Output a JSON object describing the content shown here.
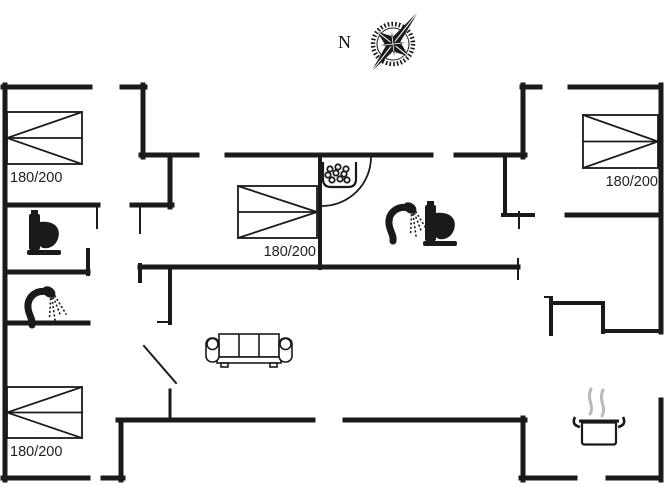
{
  "title": "Holiday house floor plan",
  "colors": {
    "line": "#1a1a1a",
    "label_text": "#1f1f1f",
    "steam": "#b9b9b9",
    "background": "#ffffff"
  },
  "plan": {
    "compass": {
      "label": "N",
      "icon": "compass-rose"
    },
    "beds": [
      {
        "label": "180/200",
        "x": 7,
        "y": 112,
        "w": 75,
        "h": 52,
        "point": "left",
        "label_x": 10,
        "label_y": 182,
        "label_anchor": "start"
      },
      {
        "label": "180/200",
        "x": 238,
        "y": 186,
        "w": 79,
        "h": 52,
        "point": "right",
        "label_x": 316,
        "label_y": 256,
        "label_anchor": "end"
      },
      {
        "label": "180/200",
        "x": 583,
        "y": 115,
        "w": 75,
        "h": 53,
        "point": "right",
        "label_x": 658,
        "label_y": 186,
        "label_anchor": "end"
      },
      {
        "label": "180/200",
        "x": 7,
        "y": 387,
        "w": 75,
        "h": 51,
        "point": "left",
        "label_x": 10,
        "label_y": 456,
        "label_anchor": "start"
      }
    ],
    "walls": [
      {
        "x1": 3,
        "y1": 87,
        "x2": 90,
        "y2": 87,
        "w": 5
      },
      {
        "x1": 122,
        "y1": 87,
        "x2": 145,
        "y2": 87,
        "w": 5
      },
      {
        "x1": 522,
        "y1": 87,
        "x2": 540,
        "y2": 87,
        "w": 5
      },
      {
        "x1": 570,
        "y1": 87,
        "x2": 661,
        "y2": 87,
        "w": 5
      },
      {
        "x1": 5,
        "y1": 85,
        "x2": 5,
        "y2": 480,
        "w": 5
      },
      {
        "x1": 661,
        "y1": 85,
        "x2": 661,
        "y2": 332,
        "w": 5
      },
      {
        "x1": 661,
        "y1": 400,
        "x2": 661,
        "y2": 480,
        "w": 5
      },
      {
        "x1": 3,
        "y1": 478,
        "x2": 88,
        "y2": 478,
        "w": 5
      },
      {
        "x1": 103,
        "y1": 478,
        "x2": 123,
        "y2": 478,
        "w": 5
      },
      {
        "x1": 121,
        "y1": 420,
        "x2": 121,
        "y2": 480,
        "w": 5
      },
      {
        "x1": 118,
        "y1": 420,
        "x2": 313,
        "y2": 420,
        "w": 5
      },
      {
        "x1": 345,
        "y1": 420,
        "x2": 525,
        "y2": 420,
        "w": 5
      },
      {
        "x1": 523,
        "y1": 418,
        "x2": 523,
        "y2": 480,
        "w": 5
      },
      {
        "x1": 521,
        "y1": 478,
        "x2": 575,
        "y2": 478,
        "w": 5
      },
      {
        "x1": 608,
        "y1": 478,
        "x2": 661,
        "y2": 478,
        "w": 5
      },
      {
        "x1": 143,
        "y1": 85,
        "x2": 143,
        "y2": 157,
        "w": 5
      },
      {
        "x1": 141,
        "y1": 155,
        "x2": 197,
        "y2": 155,
        "w": 5
      },
      {
        "x1": 227,
        "y1": 155,
        "x2": 431,
        "y2": 155,
        "w": 5
      },
      {
        "x1": 456,
        "y1": 155,
        "x2": 525,
        "y2": 155,
        "w": 5
      },
      {
        "x1": 523,
        "y1": 85,
        "x2": 523,
        "y2": 157,
        "w": 5
      },
      {
        "x1": 320,
        "y1": 155,
        "x2": 320,
        "y2": 268,
        "w": 4
      },
      {
        "x1": 505,
        "y1": 155,
        "x2": 505,
        "y2": 215,
        "w": 4
      },
      {
        "x1": 503,
        "y1": 215,
        "x2": 533,
        "y2": 215,
        "w": 4
      },
      {
        "x1": 567,
        "y1": 215,
        "x2": 661,
        "y2": 215,
        "w": 5
      },
      {
        "x1": 5,
        "y1": 205,
        "x2": 98,
        "y2": 205,
        "w": 5
      },
      {
        "x1": 97,
        "y1": 205,
        "x2": 97,
        "y2": 228,
        "w": 2
      },
      {
        "x1": 88,
        "y1": 250,
        "x2": 88,
        "y2": 274,
        "w": 4
      },
      {
        "x1": 5,
        "y1": 272,
        "x2": 88,
        "y2": 272,
        "w": 5
      },
      {
        "x1": 5,
        "y1": 323,
        "x2": 88,
        "y2": 323,
        "w": 5
      },
      {
        "x1": 170,
        "y1": 155,
        "x2": 170,
        "y2": 207,
        "w": 5
      },
      {
        "x1": 132,
        "y1": 205,
        "x2": 172,
        "y2": 205,
        "w": 5
      },
      {
        "x1": 140,
        "y1": 207,
        "x2": 140,
        "y2": 233,
        "w": 2
      },
      {
        "x1": 170,
        "y1": 267,
        "x2": 170,
        "y2": 323,
        "w": 4
      },
      {
        "x1": 158,
        "y1": 322,
        "x2": 170,
        "y2": 322,
        "w": 2
      },
      {
        "x1": 170,
        "y1": 390,
        "x2": 170,
        "y2": 421,
        "w": 3
      },
      {
        "x1": 140,
        "y1": 267,
        "x2": 518,
        "y2": 267,
        "w": 5
      },
      {
        "x1": 140,
        "y1": 265,
        "x2": 140,
        "y2": 281,
        "w": 4
      },
      {
        "x1": 518,
        "y1": 259,
        "x2": 518,
        "y2": 279,
        "w": 2
      },
      {
        "x1": 551,
        "y1": 298,
        "x2": 551,
        "y2": 334,
        "w": 4
      },
      {
        "x1": 545,
        "y1": 297,
        "x2": 552,
        "y2": 297,
        "w": 2
      },
      {
        "x1": 551,
        "y1": 303,
        "x2": 603,
        "y2": 303,
        "w": 4
      },
      {
        "x1": 603,
        "y1": 303,
        "x2": 603,
        "y2": 332,
        "w": 4
      },
      {
        "x1": 603,
        "y1": 331,
        "x2": 661,
        "y2": 331,
        "w": 4
      },
      {
        "x1": 519,
        "y1": 212,
        "x2": 519,
        "y2": 228,
        "w": 2
      }
    ],
    "doors": [
      {
        "type": "arc",
        "path": "M 371 157 A 49 49 0 0 1 322 206"
      },
      {
        "type": "leaf",
        "x1": 144,
        "y1": 346,
        "x2": 176,
        "y2": 383
      }
    ],
    "icons": [
      {
        "name": "compass-rose-icon",
        "desc": "compass rose with N label"
      },
      {
        "name": "toilet-icon",
        "desc": "WC, top-left bathroom"
      },
      {
        "name": "toilet-icon",
        "desc": "WC, middle bathroom"
      },
      {
        "name": "shower-icon",
        "desc": "hand shower, left bathroom"
      },
      {
        "name": "shower-icon",
        "desc": "hand shower, middle bathroom"
      },
      {
        "name": "whirlpool-tub-icon",
        "desc": "box with bubbles, middle bathroom"
      },
      {
        "name": "sofa-icon",
        "desc": "three-seat sofa, living room"
      },
      {
        "name": "cooking-pot-icon",
        "desc": "steaming pot, kitchen"
      }
    ]
  }
}
